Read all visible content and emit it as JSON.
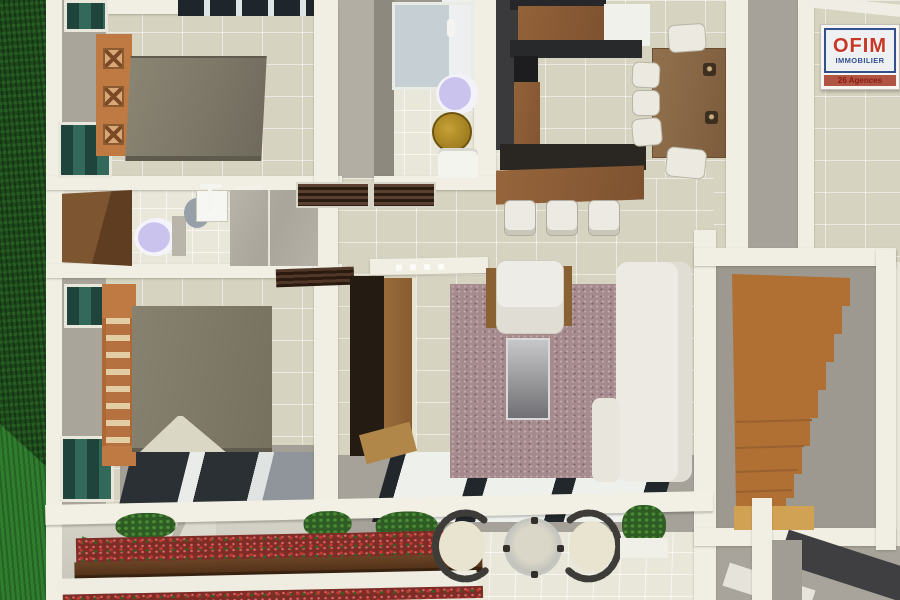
{
  "logo": {
    "title": "OFIM",
    "subtitle": "IMMOBILIER",
    "tagline": "26 Agences",
    "brand_red": "#c63726",
    "brand_blue": "#33508e",
    "band_bg": "#b05544"
  },
  "scene": {
    "description": "3D top-down architectural rendering of an apartment floor plan (real-estate visual)",
    "rooms": [
      {
        "name": "bedroom-1",
        "position": "top-left"
      },
      {
        "name": "bathroom-1",
        "position": "top-center"
      },
      {
        "name": "kitchen",
        "position": "top-center-right"
      },
      {
        "name": "dining-area",
        "position": "top-right"
      },
      {
        "name": "bathroom-2",
        "position": "middle-left"
      },
      {
        "name": "bedroom-2",
        "position": "lower-left"
      },
      {
        "name": "hallway",
        "position": "center"
      },
      {
        "name": "living-room",
        "position": "center-right"
      },
      {
        "name": "staircase-room",
        "position": "right"
      },
      {
        "name": "terrace-garden",
        "position": "bottom"
      },
      {
        "name": "lawn",
        "position": "left-edge"
      }
    ],
    "furniture": [
      "double-bed",
      "x-slat-headboard",
      "ladder-headboard",
      "toilet",
      "shower",
      "pedestal-sink",
      "gold-stool",
      "kitchen-counters",
      "breakfast-bar",
      "bar-stools",
      "dining-table",
      "dining-chairs",
      "tv-cabinet",
      "area-rug",
      "armchair",
      "glass-coffee-table",
      "corner-sofa",
      "wooden-staircase",
      "skylights",
      "patio-round-table",
      "curved-patio-chairs",
      "flower-planters",
      "potted-plants"
    ],
    "palette": {
      "grass": "#1d4a1b",
      "grass_light": "#2f7d2e",
      "floor_tile": "#d7d3c1",
      "bath_tile": "#e9e7da",
      "wall": "#f1efe3",
      "gray_wall": "#a9a59b",
      "bed": "#7f7b6e",
      "headboard_wood": "#bf7a44",
      "window_glass": "#1e443c",
      "kitchen_dark_wall": "#3a3a3c",
      "counter_wood": "#8a5c36",
      "bar_counter": "#2a2723",
      "dining_table": "#8a6a47",
      "rug": "#a68b8e",
      "sofa": "#eceae2",
      "stairs_wood": "#b06f33",
      "stairs_landing": "#d2a254",
      "roof": "#a6a29a",
      "skylight_frame": "#22272c",
      "flowers_red": "#7e2c26",
      "foliage": "#2e5c24"
    }
  }
}
